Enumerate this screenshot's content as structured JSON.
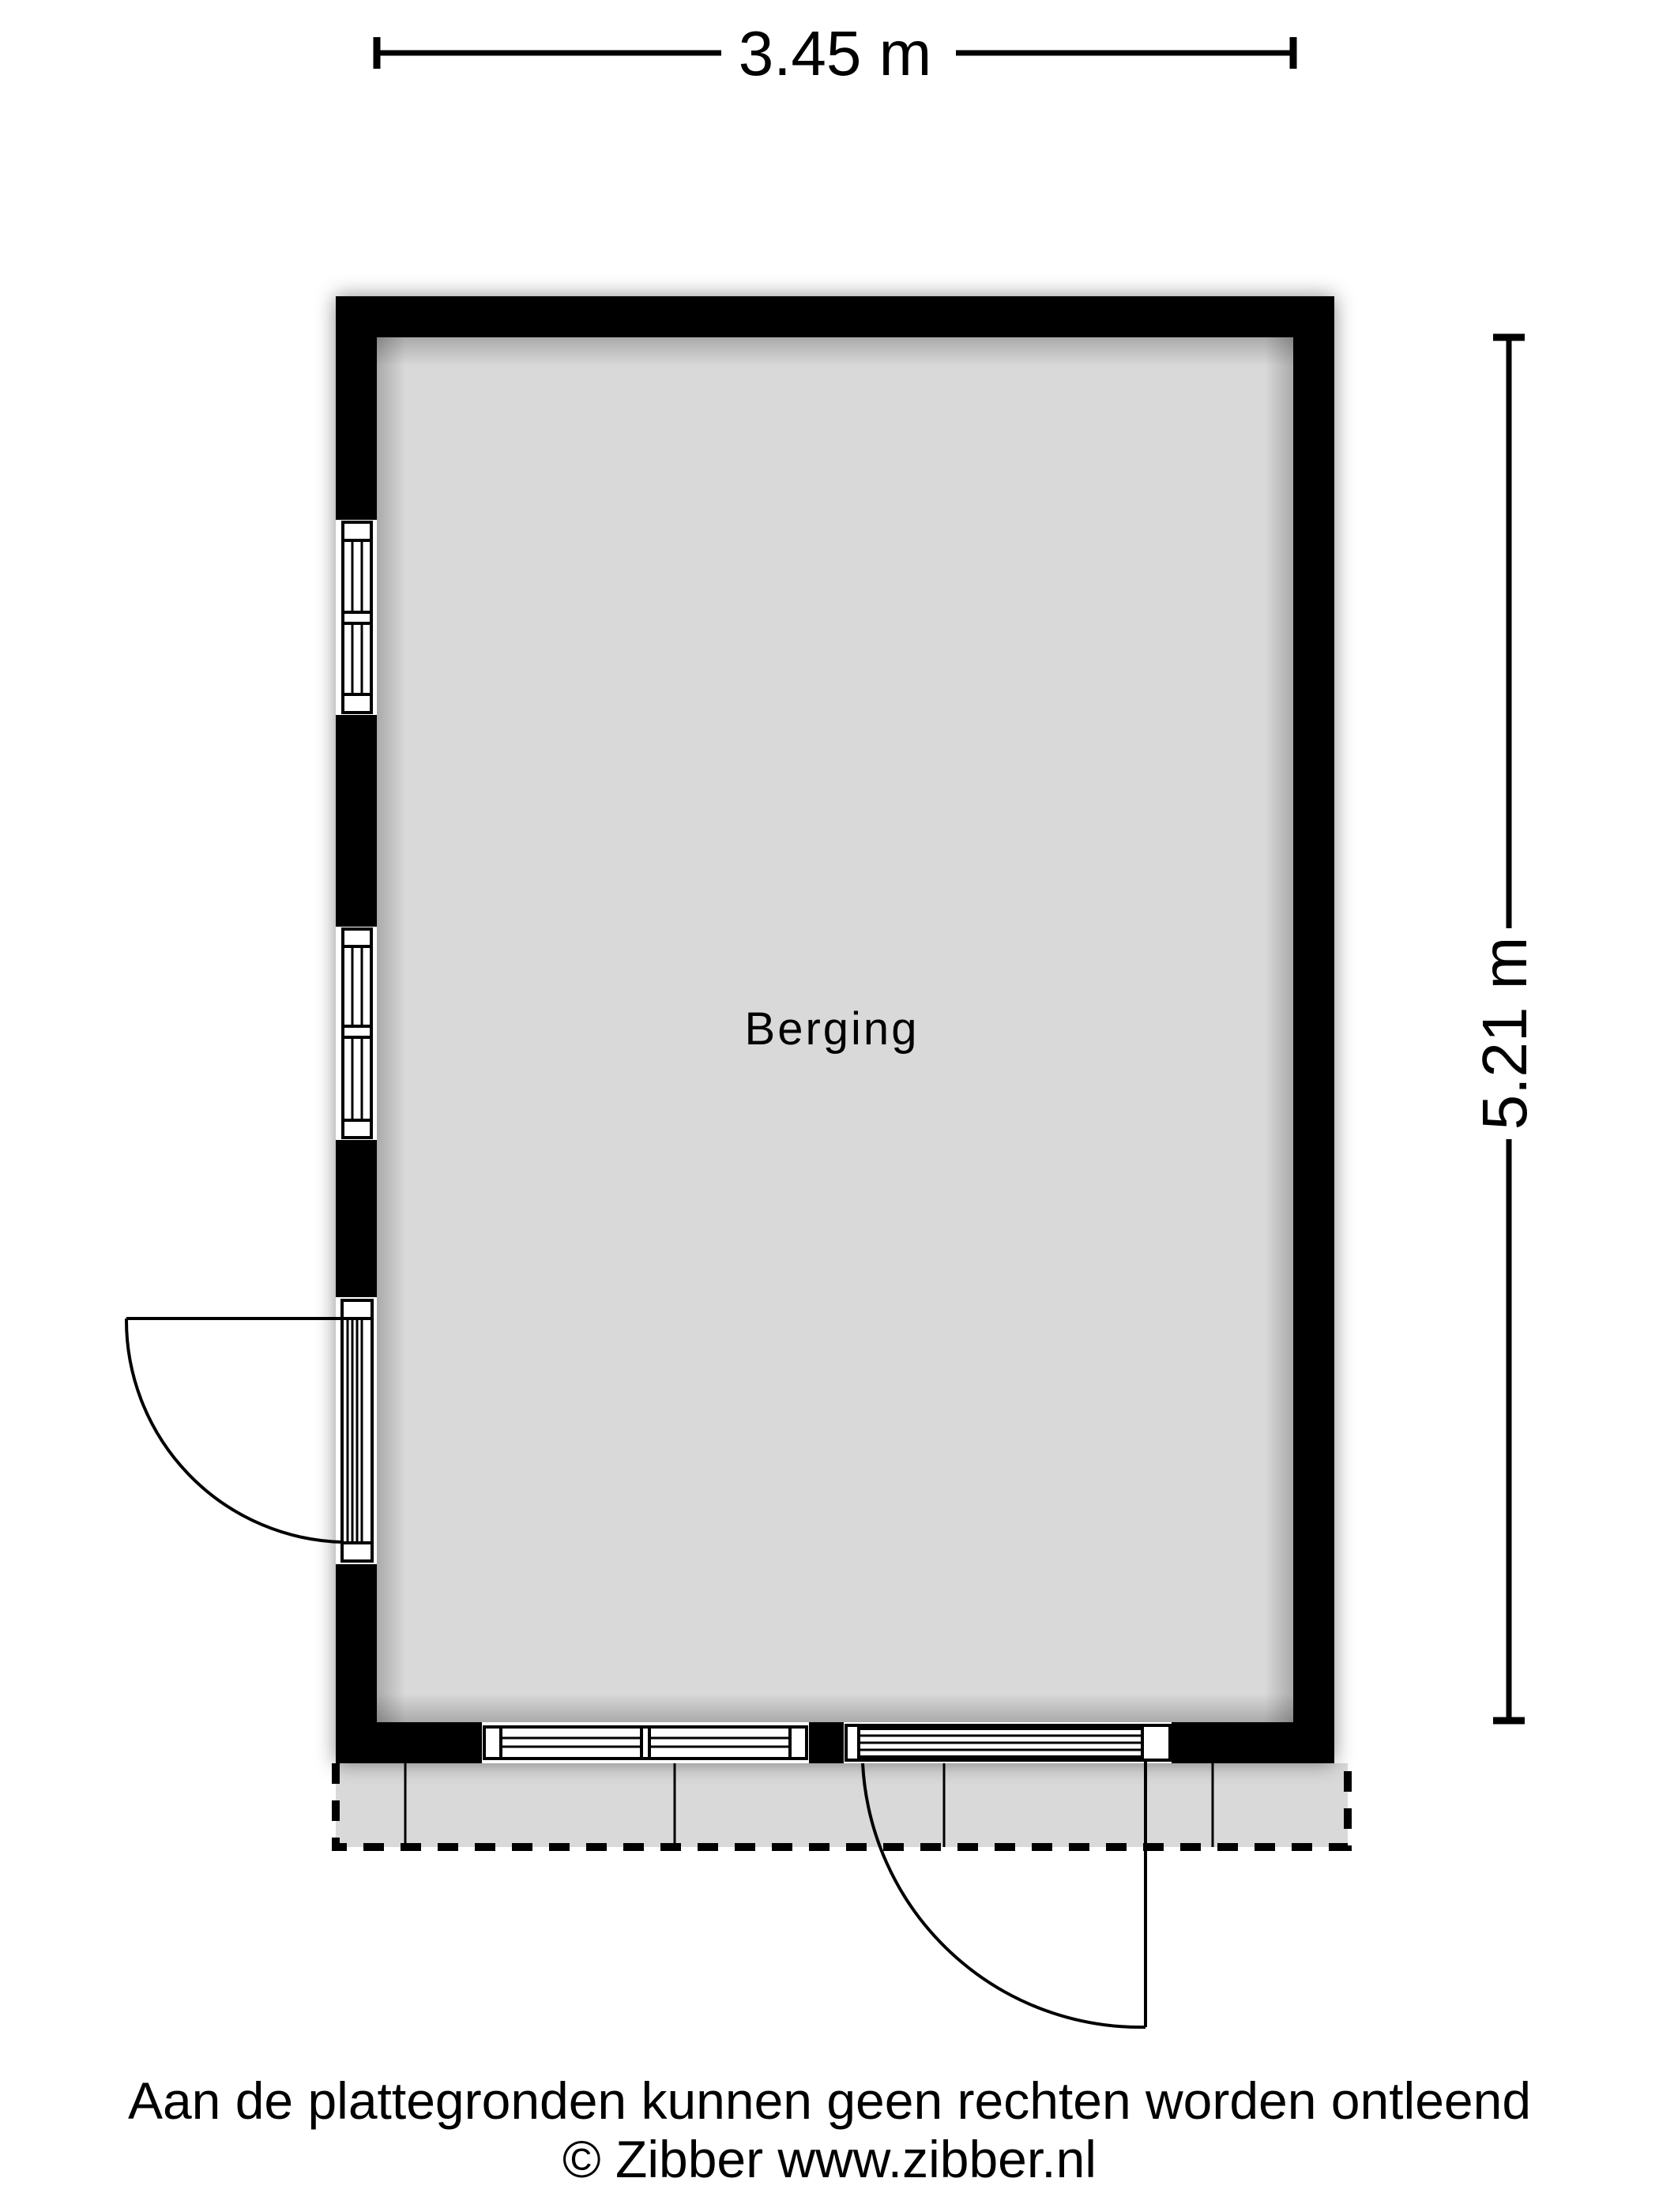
{
  "floorplan": {
    "room_label": "Berging",
    "width_dimension": "3.45 m",
    "height_dimension": "5.21 m"
  },
  "footer": {
    "disclaimer": "Aan de plattegronden kunnen geen rechten worden ontleend",
    "copyright": "© Zibber www.zibber.nl"
  },
  "colors": {
    "wall": "#000000",
    "floor": "#d9d9d9",
    "terrace": "#d9d9d9",
    "line": "#000000",
    "background": "#ffffff"
  }
}
